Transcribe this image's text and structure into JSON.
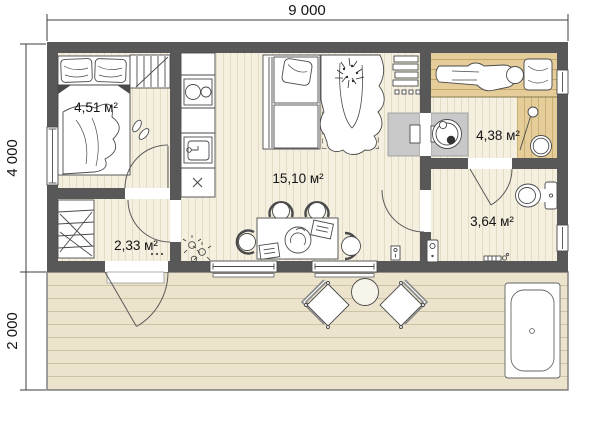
{
  "plan": {
    "type": "floor-plan",
    "dimensions": {
      "overall_width": "9 000",
      "house_depth": "4 000",
      "terrace_depth": "2 000"
    },
    "rooms": {
      "bedroom": {
        "area": "4,51 м²"
      },
      "hall": {
        "area": "2,33 м²"
      },
      "living": {
        "area": "15,10 м²"
      },
      "sauna": {
        "area": "4,38 м²"
      },
      "bathroom": {
        "area": "3,64 м²"
      }
    },
    "colors": {
      "wall": "#585858",
      "floor": "#f4efdf",
      "floor_line": "#e2dcc5",
      "wood": "#e4cd99",
      "wood_line": "#c2a667",
      "terrace": "#ebe3cb",
      "terrace_line": "#cdc4a7",
      "stove_shield": "#c8c8c8",
      "line_art": "#4a4a4a"
    }
  }
}
